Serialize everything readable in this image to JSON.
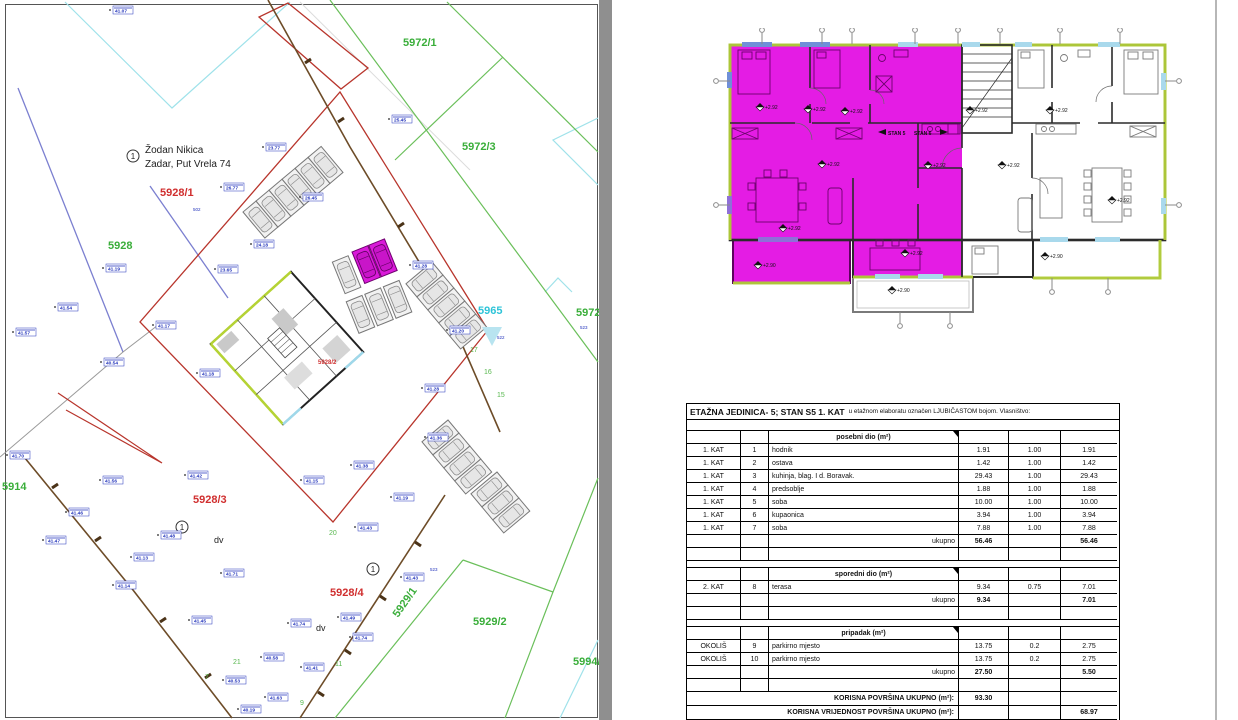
{
  "colors": {
    "highlight_magenta": "#e41ce4",
    "outline_green": "#b3cf3a",
    "parcel_red": "#d02f2f",
    "parcel_green": "#3aae3a",
    "parcel_cyan": "#2fc4d8",
    "point_blue": "#2233bb"
  },
  "map": {
    "owner": {
      "marker": "1",
      "name": "Žodan Nikica",
      "address": "Zadar, Put Vrela 74"
    },
    "circle_marker": "1",
    "parcels": [
      {
        "x": 403,
        "y": 46,
        "v": "5972/1",
        "cls": "pg"
      },
      {
        "x": 462,
        "y": 150,
        "v": "5972/3",
        "cls": "pg"
      },
      {
        "x": 576,
        "y": 316,
        "v": "5972/2",
        "cls": "pg"
      },
      {
        "x": 478,
        "y": 314,
        "v": "5965",
        "cls": "pc"
      },
      {
        "x": 160,
        "y": 196,
        "v": "5928/1",
        "cls": "pr"
      },
      {
        "x": 108,
        "y": 249,
        "v": "5928",
        "cls": "pg"
      },
      {
        "x": 318,
        "y": 364,
        "v": "5928/2",
        "cls": "prs"
      },
      {
        "x": 193,
        "y": 503,
        "v": "5928/3",
        "cls": "pr"
      },
      {
        "x": 330,
        "y": 596,
        "v": "5928/4",
        "cls": "pr"
      },
      {
        "x": 473,
        "y": 625,
        "v": "5929/2",
        "cls": "pg"
      },
      {
        "x": 573,
        "y": 665,
        "v": "5994/1",
        "cls": "pg"
      },
      {
        "x": 2,
        "y": 490,
        "v": "5914",
        "cls": "pg"
      },
      {
        "x": 398,
        "y": 618,
        "v": "5929/1",
        "cls": "pg",
        "rot": -55
      }
    ],
    "green_nums": [
      {
        "x": 470,
        "y": 352,
        "v": "17"
      },
      {
        "x": 484,
        "y": 374,
        "v": "16"
      },
      {
        "x": 497,
        "y": 397,
        "v": "15"
      },
      {
        "x": 329,
        "y": 535,
        "v": "20"
      },
      {
        "x": 233,
        "y": 664,
        "v": "21"
      },
      {
        "x": 335,
        "y": 666,
        "v": "11"
      },
      {
        "x": 300,
        "y": 705,
        "v": "9"
      },
      {
        "x": 205,
        "y": 679,
        "v": "7"
      }
    ],
    "small_ids": [
      {
        "x": 430,
        "y": 571,
        "v": "523"
      },
      {
        "x": 580,
        "y": 329,
        "v": "523"
      },
      {
        "x": 497,
        "y": 339,
        "v": "522"
      },
      {
        "x": 193,
        "y": 211,
        "v": "502"
      }
    ],
    "dv": [
      {
        "x": 214,
        "y": 543,
        "v": "dv"
      },
      {
        "x": 316,
        "y": 631,
        "v": "dv"
      }
    ],
    "points": [
      {
        "x": 113,
        "y": 12,
        "v": "41.07"
      },
      {
        "x": 266,
        "y": 149,
        "v": "23.77"
      },
      {
        "x": 224,
        "y": 189,
        "v": "26.77"
      },
      {
        "x": 303,
        "y": 199,
        "v": "26.45"
      },
      {
        "x": 254,
        "y": 246,
        "v": "24.18"
      },
      {
        "x": 392,
        "y": 121,
        "v": "25.45"
      },
      {
        "x": 106,
        "y": 270,
        "v": "41.19"
      },
      {
        "x": 58,
        "y": 309,
        "v": "41.54"
      },
      {
        "x": 16,
        "y": 334,
        "v": "41.57"
      },
      {
        "x": 156,
        "y": 327,
        "v": "41.17"
      },
      {
        "x": 104,
        "y": 364,
        "v": "40.54"
      },
      {
        "x": 200,
        "y": 375,
        "v": "41.18"
      },
      {
        "x": 218,
        "y": 271,
        "v": "23.65"
      },
      {
        "x": 413,
        "y": 267,
        "v": "41.28"
      },
      {
        "x": 450,
        "y": 332,
        "v": "41.20"
      },
      {
        "x": 425,
        "y": 390,
        "v": "41.28"
      },
      {
        "x": 428,
        "y": 439,
        "v": "41.36"
      },
      {
        "x": 188,
        "y": 477,
        "v": "41.42"
      },
      {
        "x": 304,
        "y": 482,
        "v": "41.15"
      },
      {
        "x": 354,
        "y": 467,
        "v": "41.38"
      },
      {
        "x": 394,
        "y": 499,
        "v": "41.19"
      },
      {
        "x": 161,
        "y": 537,
        "v": "41.48"
      },
      {
        "x": 358,
        "y": 529,
        "v": "41.43"
      },
      {
        "x": 224,
        "y": 575,
        "v": "41.71"
      },
      {
        "x": 192,
        "y": 622,
        "v": "41.45"
      },
      {
        "x": 291,
        "y": 625,
        "v": "41.74"
      },
      {
        "x": 341,
        "y": 619,
        "v": "41.49"
      },
      {
        "x": 404,
        "y": 579,
        "v": "41.43"
      },
      {
        "x": 103,
        "y": 482,
        "v": "41.56"
      },
      {
        "x": 69,
        "y": 514,
        "v": "41.46"
      },
      {
        "x": 46,
        "y": 542,
        "v": "41.47"
      },
      {
        "x": 264,
        "y": 659,
        "v": "40.58"
      },
      {
        "x": 304,
        "y": 669,
        "v": "41.41"
      },
      {
        "x": 226,
        "y": 682,
        "v": "40.53"
      },
      {
        "x": 268,
        "y": 699,
        "v": "41.63"
      },
      {
        "x": 241,
        "y": 711,
        "v": "40.19"
      },
      {
        "x": 353,
        "y": 639,
        "v": "41.74"
      },
      {
        "x": 116,
        "y": 587,
        "v": "41.14"
      },
      {
        "x": 10,
        "y": 457,
        "v": "41.70"
      },
      {
        "x": 134,
        "y": 559,
        "v": "41.13"
      }
    ]
  },
  "plan": {
    "elev292": "+2.92",
    "elev290": "+2.90",
    "stan_left": "STAN 5",
    "stan_right": "STAN 6"
  },
  "table": {
    "title_main": "ETAŽNA JEDINICA- 5; STAN S5 1. KAT",
    "title_rest": "u etažnom elaboratu označen LJUBIČASTOM bojom. Vlasništvo:",
    "rows": [
      {
        "t": "gap",
        "tall": true
      },
      {
        "t": "sec",
        "c3": "posebni dio (m²)"
      },
      {
        "t": "d",
        "c": [
          "1. KAT",
          "1",
          "hodnik",
          "1.91",
          "1.00",
          "1.91"
        ]
      },
      {
        "t": "d",
        "c": [
          "1. KAT",
          "2",
          "ostava",
          "1.42",
          "1.00",
          "1.42"
        ]
      },
      {
        "t": "d",
        "c": [
          "1. KAT",
          "3",
          "kuhinja, blag. I d. Boravak.",
          "29.43",
          "1.00",
          "29.43"
        ]
      },
      {
        "t": "d",
        "c": [
          "1. KAT",
          "4",
          "predsoblje",
          "1.88",
          "1.00",
          "1.88"
        ]
      },
      {
        "t": "d",
        "c": [
          "1. KAT",
          "5",
          "soba",
          "10.00",
          "1.00",
          "10.00"
        ]
      },
      {
        "t": "d",
        "c": [
          "1. KAT",
          "6",
          "kupaonica",
          "3.94",
          "1.00",
          "3.94"
        ]
      },
      {
        "t": "d",
        "c": [
          "1. KAT",
          "7",
          "soba",
          "7.88",
          "1.00",
          "7.88"
        ]
      },
      {
        "t": "tot",
        "c": [
          "",
          "",
          "ukupno",
          "56.46",
          "",
          "56.46"
        ]
      },
      {
        "t": "empty"
      },
      {
        "t": "gap"
      },
      {
        "t": "sec",
        "c3": "sporedni dio (m²)"
      },
      {
        "t": "d",
        "c": [
          "2. KAT",
          "8",
          "terasa",
          "9.34",
          "0.75",
          "7.01"
        ]
      },
      {
        "t": "tot",
        "c": [
          "",
          "",
          "ukupno",
          "9.34",
          "",
          "7.01"
        ]
      },
      {
        "t": "empty"
      },
      {
        "t": "gap"
      },
      {
        "t": "sec",
        "c3": "pripadak (m²)"
      },
      {
        "t": "d",
        "c": [
          "OKOLIŠ",
          "9",
          "parkirno mjesto",
          "13.75",
          "0.2",
          "2.75"
        ]
      },
      {
        "t": "d",
        "c": [
          "OKOLIŠ",
          "10",
          "parkirno mjesto",
          "13.75",
          "0.2",
          "2.75"
        ]
      },
      {
        "t": "tot",
        "c": [
          "",
          "",
          "ukupno",
          "27.50",
          "",
          "5.50"
        ]
      },
      {
        "t": "empty"
      },
      {
        "t": "grand",
        "c": [
          "KORISNA POVRŠINA UKUPNO (m²):",
          "93.30",
          "",
          ""
        ]
      },
      {
        "t": "grand",
        "c": [
          "KORISNA VRIJEDNOST POVRŠINA UKUPNO (m²):",
          "",
          "",
          "68.97"
        ]
      }
    ]
  }
}
